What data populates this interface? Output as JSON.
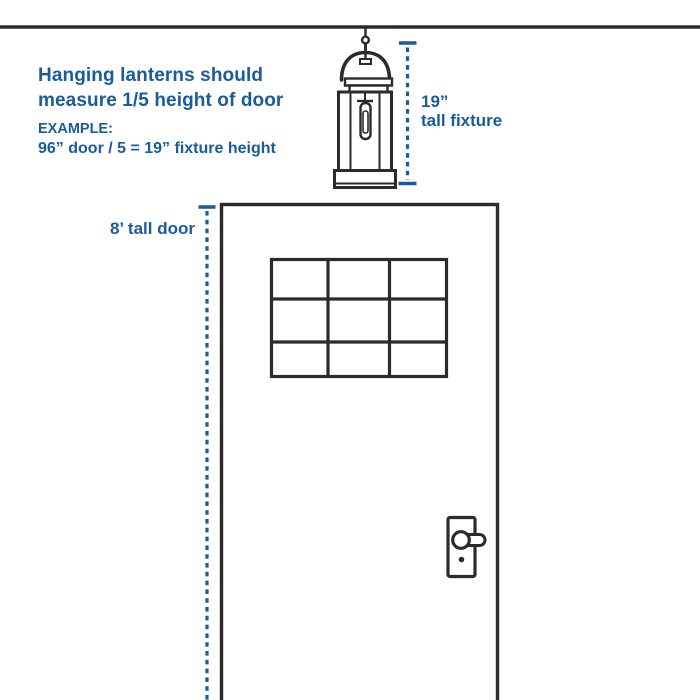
{
  "colors": {
    "blue": "#1A5B9C",
    "ink": "#2B2B2B",
    "background": "#FFFFFF"
  },
  "guideline": {
    "line1": "Hanging lanterns should",
    "line2": "measure 1/5 height of door"
  },
  "example": {
    "label": "EXAMPLE:",
    "formula": "96” door / 5 = 19” fixture height"
  },
  "fixture_measure": {
    "line1": "19”",
    "line2": "tall fixture"
  },
  "door_measure": {
    "label": "8’ tall door"
  },
  "figures": {
    "ceiling": "ceiling-line",
    "lantern": "hanging-lantern",
    "door": "front-door",
    "window_panes": {
      "rows": 3,
      "cols": 3
    },
    "handle": "lever-handle"
  }
}
